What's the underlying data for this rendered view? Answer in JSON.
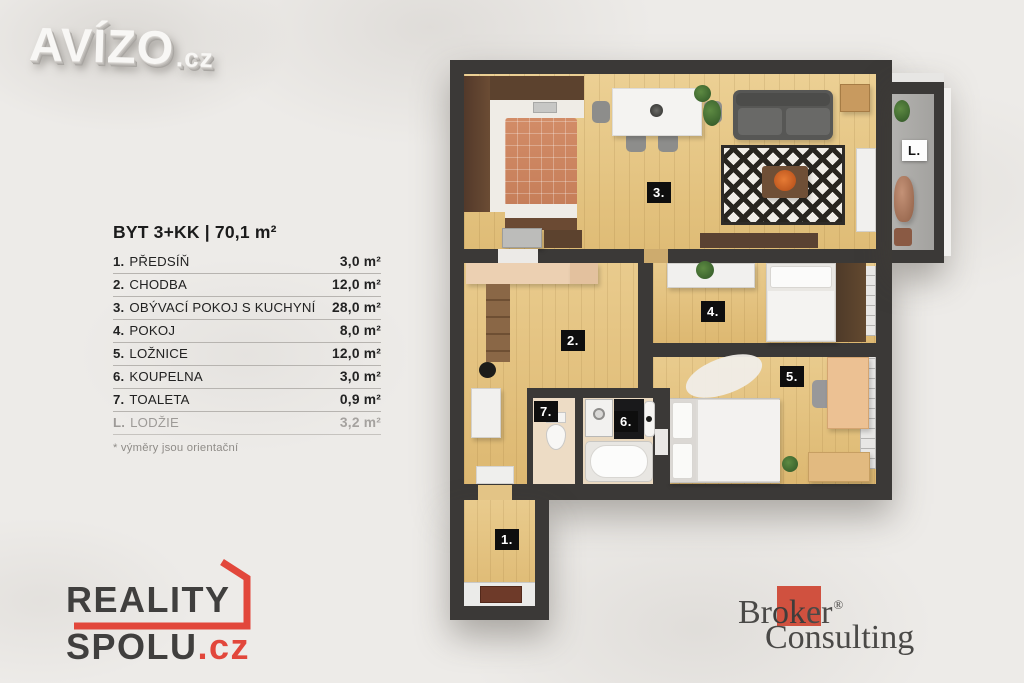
{
  "colors": {
    "background": "#edebe8",
    "wall": "#3b3937",
    "wood_floor": "#e6c988",
    "kitchen_tile": "#cd8762",
    "loggia_floor": "#abaaa7",
    "label_bg": "#0e0e0e",
    "label_fg": "#ffffff",
    "reality_red": "#e2473b",
    "broker_red": "#d0513f"
  },
  "avizo": {
    "name": "AVÍZO",
    "tld": ".cz"
  },
  "legend": {
    "title": "BYT 3+KK | 70,1 m²",
    "rows": [
      {
        "num": "1.",
        "name": "PŘEDSÍŇ",
        "area": "3,0 m²"
      },
      {
        "num": "2.",
        "name": "CHODBA",
        "area": "12,0 m²"
      },
      {
        "num": "3.",
        "name": "OBÝVACÍ POKOJ S KUCHYNÍ",
        "area": "28,0 m²"
      },
      {
        "num": "4.",
        "name": "POKOJ",
        "area": "8,0 m²"
      },
      {
        "num": "5.",
        "name": "LOŽNICE",
        "area": "12,0 m²"
      },
      {
        "num": "6.",
        "name": "KOUPELNA",
        "area": "3,0 m²"
      },
      {
        "num": "7.",
        "name": "TOALETA",
        "area": "0,9 m²"
      },
      {
        "num": "L.",
        "name": "LODŽIE",
        "area": "3,2 m²"
      }
    ],
    "footnote": "* výměry jsou orientační"
  },
  "plan": {
    "labels": {
      "r1": "1.",
      "r2": "2.",
      "r3": "3.",
      "r4": "4.",
      "r5": "5.",
      "r6": "6.",
      "r7": "7.",
      "loggia": "L."
    }
  },
  "reality_spolu": {
    "line1": "REALITY",
    "line2": "SPOLU",
    "tld": ".cz"
  },
  "broker": {
    "pre": "Br",
    "mid": "ok",
    "post": "er",
    "reg": "®",
    "line2": "Consulting"
  }
}
